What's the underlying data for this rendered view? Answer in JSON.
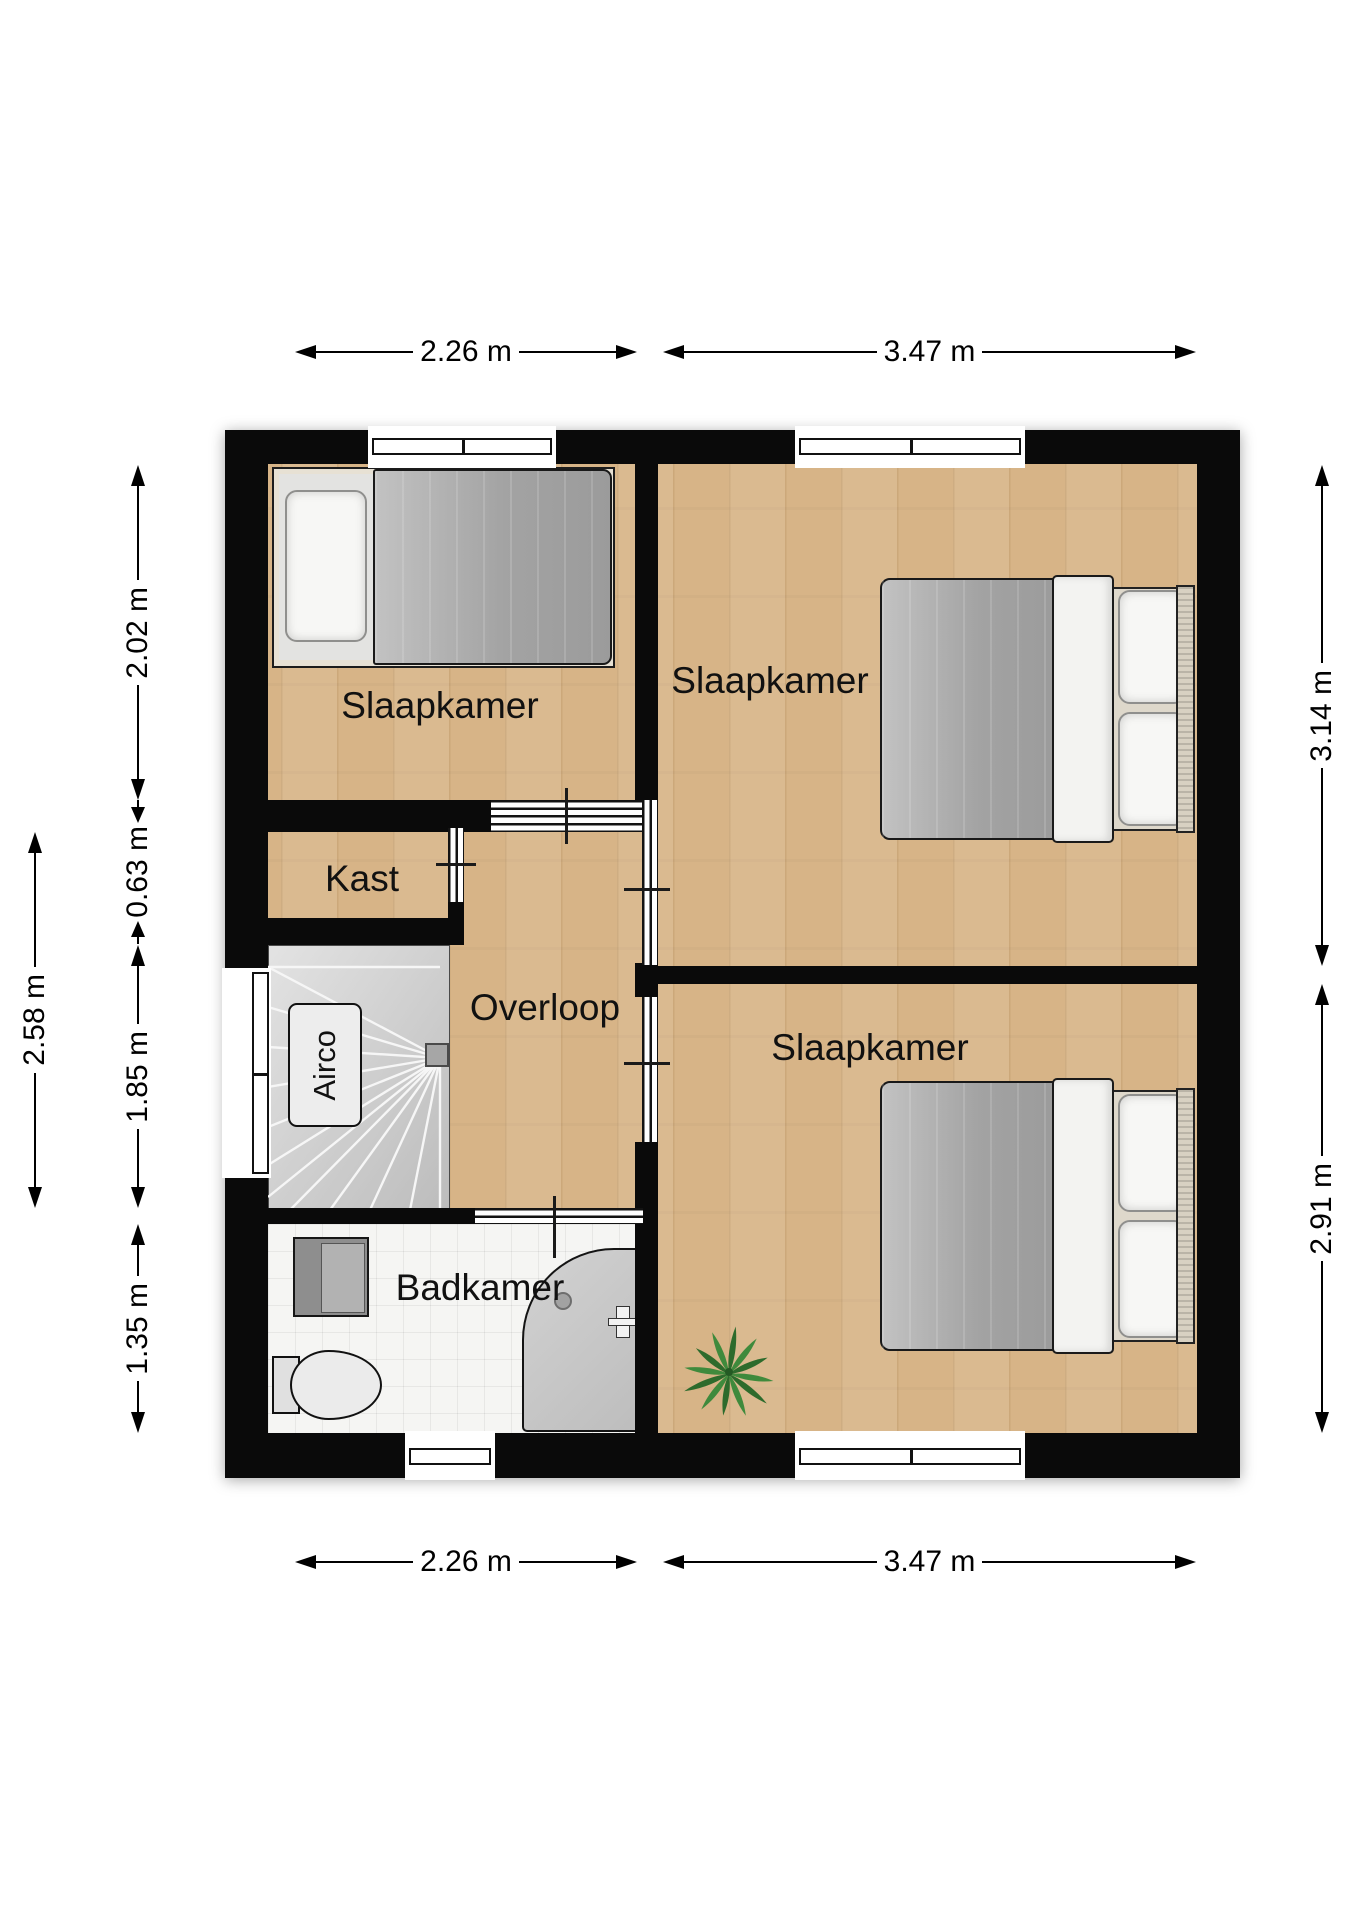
{
  "rooms": {
    "bedroom_left": "Slaapkamer",
    "bedroom_top_right": "Slaapkamer",
    "bedroom_bottom_right": "Slaapkamer",
    "closet": "Kast",
    "landing": "Overloop",
    "bathroom": "Badkamer"
  },
  "labels": {
    "airco": "Airco"
  },
  "dimensions": {
    "top_left": "2.26 m",
    "top_right": "3.47 m",
    "bottom_left": "2.26 m",
    "bottom_right": "3.47 m",
    "right_top": "3.14 m",
    "right_bottom": "2.91 m",
    "left_inner_bedroom": "2.02 m",
    "left_inner_closet": "0.63 m",
    "left_inner_stairs": "1.85 m",
    "left_inner_bathroom": "1.35 m",
    "left_outer": "2.58 m"
  },
  "colors": {
    "wall": "#0a0a0a",
    "wood_floor": "#d7b487",
    "tile_floor": "#f5f5f3",
    "stairs": "#cdcdcd",
    "duvet": "#a3a3a3",
    "plant": "#3f8a3c"
  }
}
